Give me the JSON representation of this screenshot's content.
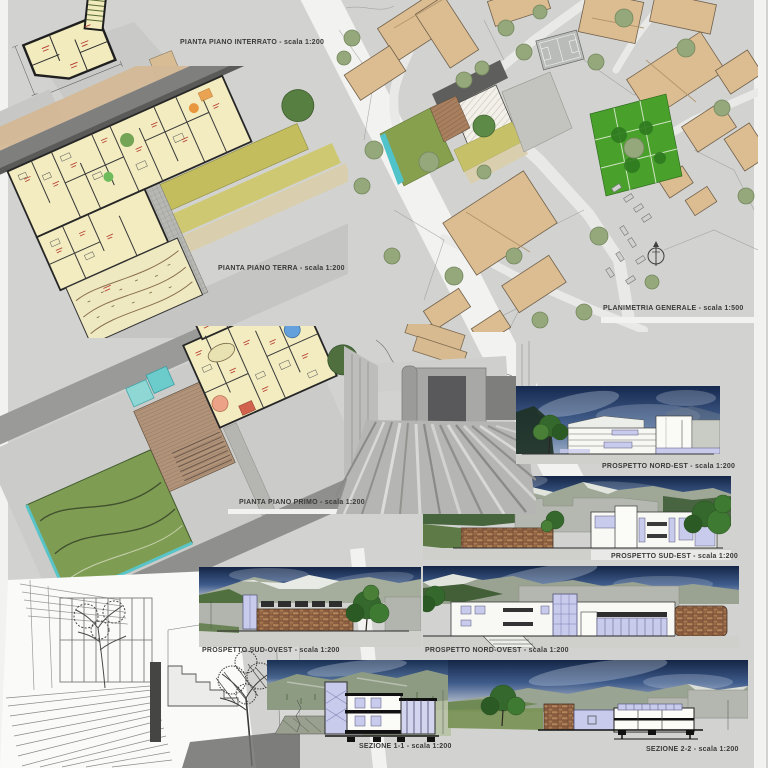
{
  "labels": {
    "interrato": "PIANTA PIANO INTERRATO  - scala 1:200",
    "terra": "PIANTA PIANO TERRA - scala 1:200",
    "planimetria": "PLANIMETRIA GENERALE  - scala 1:500",
    "primo": "PIANTA PIANO PRIMO - scala 1:200",
    "prospetto_nord_est": "PROSPETTO NORD-EST  - scala 1:200",
    "prospetto_sud_est": "PROSPETTO SUD-EST  - scala 1:200",
    "prospetto_sud_ovest": "PROSPETTO SUD-OVEST  - scala 1:200",
    "prospetto_nord_ovest": "PROSPETTO NORD-OVEST  - scala 1:200",
    "sezione_1_1": "SEZIONE 1-1  - scala 1:200",
    "sezione_2_2": "SEZIONE 2-2  - scala 1:200"
  },
  "icons": {
    "north_arrow": "north-arrow-icon"
  },
  "colors": {
    "board_background": "#d2d3d1",
    "sheet_white": "#f2f2f0",
    "plan_room_yellow": "#f2ecc0",
    "plan_wall_dark": "#262626",
    "context_roof_tan": "#dcbd92",
    "lawn_olive": "#c3bd5e",
    "garden_green": "#49a12c",
    "courtyard_green": "#7f9d52",
    "pool_teal": "#58c4c8",
    "elevation_sky_navy": "#16294f",
    "window_lavender": "#c9cbec",
    "stone_wall_brown": "#8a5f46",
    "label_text": "#3a3a3a",
    "plan_annotation_red": "#b5372a"
  }
}
